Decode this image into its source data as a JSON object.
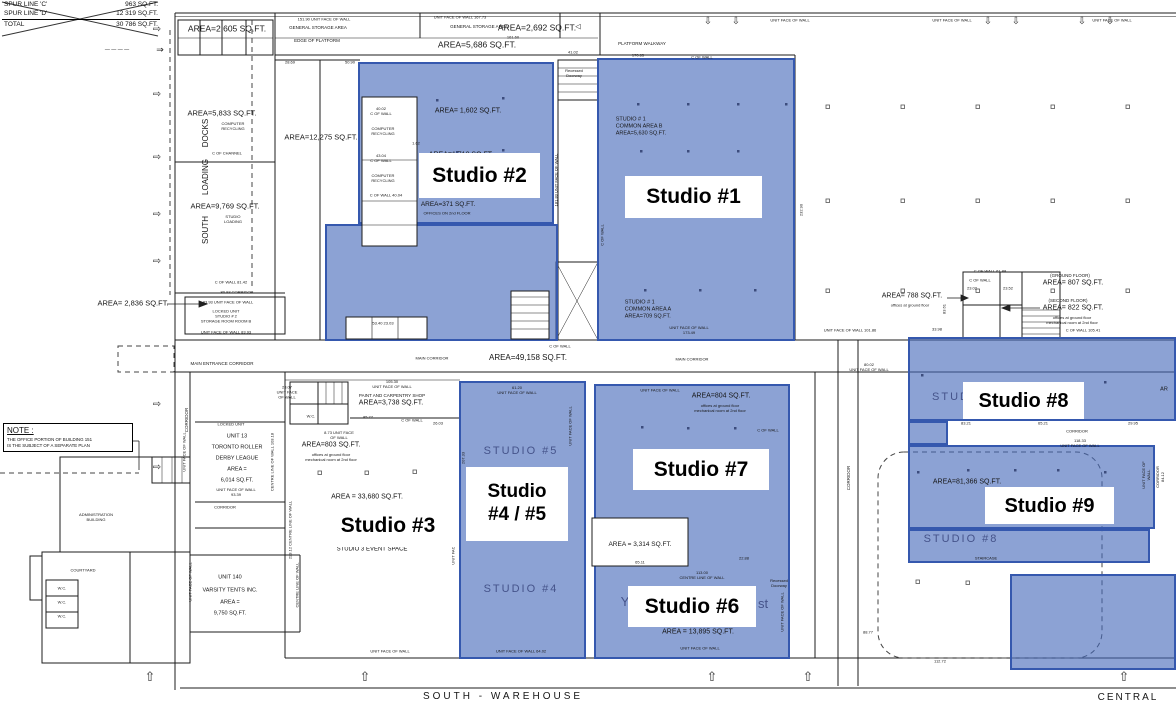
{
  "colors": {
    "highlight_fill": "rgba(70,105,185,0.62)",
    "highlight_border": "#3558ae",
    "wall": "#1c1c1c",
    "ghost_text": "#45538a",
    "plan_text": "#161616"
  },
  "spur_table": {
    "rows": [
      {
        "label": "SPUR LINE 'C'",
        "value": "963 SQ.FT."
      },
      {
        "label": "SPUR LINE 'D'",
        "value": "12 319 SQ.FT."
      },
      {
        "label": "TOTAL",
        "value": "30 786 SQ.FT."
      }
    ]
  },
  "note_box": {
    "title": "NOTE :",
    "body": "THE OFFICE PORTION OF BUILDING 151\nIS THE SUBJECT OF A SEPARATE PLAN"
  },
  "regions": [
    {
      "name": "studio-2-upper",
      "x": 358,
      "y": 62,
      "w": 196,
      "h": 162
    },
    {
      "name": "studio-2-lower",
      "x": 325,
      "y": 224,
      "w": 233,
      "h": 117
    },
    {
      "name": "studio-1",
      "x": 597,
      "y": 58,
      "w": 198,
      "h": 283
    },
    {
      "name": "studio-4-5",
      "x": 459,
      "y": 381,
      "w": 127,
      "h": 278
    },
    {
      "name": "studio-6-7",
      "x": 594,
      "y": 384,
      "w": 196,
      "h": 275
    },
    {
      "name": "studio-8-top",
      "x": 908,
      "y": 337,
      "w": 268,
      "h": 84
    },
    {
      "name": "studio-8-link",
      "x": 908,
      "y": 421,
      "w": 40,
      "h": 24
    },
    {
      "name": "studio-8-9-mid",
      "x": 908,
      "y": 445,
      "w": 247,
      "h": 84
    },
    {
      "name": "studio-8-strip",
      "x": 908,
      "y": 529,
      "w": 242,
      "h": 34
    },
    {
      "name": "studio-9-lower",
      "x": 1010,
      "y": 574,
      "w": 166,
      "h": 96
    }
  ],
  "studio_overlays": [
    {
      "name": "studio-2",
      "text": "Studio #2",
      "x": 419,
      "y": 153,
      "w": 121,
      "h": 45,
      "fs": 21
    },
    {
      "name": "studio-1",
      "text": "Studio #1",
      "x": 625,
      "y": 176,
      "w": 137,
      "h": 42,
      "fs": 21
    },
    {
      "name": "studio-3",
      "text": "Studio #3",
      "x": 318,
      "y": 505,
      "w": 140,
      "h": 42,
      "fs": 21
    },
    {
      "name": "studio-4-5",
      "text": "Studio\n#4 / #5",
      "x": 466,
      "y": 467,
      "w": 102,
      "h": 74,
      "fs": 19
    },
    {
      "name": "studio-7",
      "text": "Studio #7",
      "x": 633,
      "y": 449,
      "w": 136,
      "h": 41,
      "fs": 21
    },
    {
      "name": "studio-6",
      "text": "Studio #6",
      "x": 628,
      "y": 586,
      "w": 128,
      "h": 41,
      "fs": 21
    },
    {
      "name": "studio-8",
      "text": "Studio #8",
      "x": 963,
      "y": 382,
      "w": 121,
      "h": 37,
      "fs": 20
    },
    {
      "name": "studio-9",
      "text": "Studio #9",
      "x": 985,
      "y": 487,
      "w": 129,
      "h": 37,
      "fs": 20
    }
  ],
  "arrows": {
    "left": {
      "glyph": "⇨",
      "x": 157,
      "ys": [
        30,
        95,
        158,
        215,
        262,
        405,
        468
      ]
    },
    "top": {
      "glyph": "⇩",
      "y": 22,
      "xs": [
        708,
        736,
        988,
        1016,
        1082,
        1110
      ]
    },
    "bottom": {
      "glyph": "⇧",
      "y": 677,
      "xs": [
        150,
        365,
        712,
        808,
        1124
      ]
    }
  },
  "plan_texts": [
    {
      "t": "AREA=2,605 SQ.FT.",
      "x": 227,
      "y": 29,
      "s": 8.5
    },
    {
      "t": "151.90   UNIT FACE OF WALL",
      "x": 324,
      "y": 19,
      "s": 4
    },
    {
      "t": "GENERAL STORAGE AREA",
      "x": 318,
      "y": 28,
      "s": 4.5
    },
    {
      "t": "EDGE OF PLATFORM",
      "x": 317,
      "y": 41,
      "s": 4.5
    },
    {
      "t": "28.69",
      "x": 290,
      "y": 62,
      "s": 4
    },
    {
      "t": "50.90",
      "x": 350,
      "y": 62,
      "s": 4
    },
    {
      "t": "UNIT FACE OF WALL  167.73",
      "x": 460,
      "y": 17,
      "s": 4
    },
    {
      "t": "GENERAL STORAGE AREA",
      "x": 479,
      "y": 27,
      "s": 4.5
    },
    {
      "t": "AREA=2,692 SQ.FT.",
      "x": 537,
      "y": 28,
      "s": 8.5
    },
    {
      "t": "161.60",
      "x": 513,
      "y": 37,
      "s": 4
    },
    {
      "t": "AREA=5,686 SQ.FT.",
      "x": 477,
      "y": 45,
      "s": 8.5
    },
    {
      "t": "41.02",
      "x": 573,
      "y": 52,
      "s": 4
    },
    {
      "t": "◁",
      "x": 578,
      "y": 28,
      "s": 7
    },
    {
      "t": "PLATFORM WALKWAY",
      "x": 642,
      "y": 44,
      "s": 4.5
    },
    {
      "t": "170.65",
      "x": 638,
      "y": 55,
      "s": 4
    },
    {
      "t": "C OF WALL",
      "x": 702,
      "y": 57,
      "s": 4
    },
    {
      "t": "UNIT FACE OF WALL",
      "x": 790,
      "y": 20,
      "s": 4
    },
    {
      "t": "UNIT FACE OF WALL",
      "x": 952,
      "y": 20,
      "s": 4
    },
    {
      "t": "UNIT FACE OF WALL",
      "x": 1112,
      "y": 20,
      "s": 4
    },
    {
      "t": "AREA=5,833 SQ.FT.",
      "x": 222,
      "y": 113,
      "s": 7.5
    },
    {
      "t": "COMPUTER\nRECYCLING",
      "x": 233,
      "y": 126,
      "s": 4
    },
    {
      "t": "DOCKS",
      "x": 206,
      "y": 133,
      "s": 8,
      "r": -90
    },
    {
      "t": "C OF CHANNEL",
      "x": 227,
      "y": 153,
      "s": 4
    },
    {
      "t": "LOADING",
      "x": 206,
      "y": 177,
      "s": 8,
      "r": -90
    },
    {
      "t": "AREA=9,769 SQ.FT.",
      "x": 225,
      "y": 206,
      "s": 7.5
    },
    {
      "t": "STUDIO\nLOADING",
      "x": 233,
      "y": 219,
      "s": 4
    },
    {
      "t": "SOUTH",
      "x": 206,
      "y": 230,
      "s": 8,
      "r": -90
    },
    {
      "t": "C OF WALL  81.42",
      "x": 231,
      "y": 282,
      "s": 4
    },
    {
      "t": "80.93   CORRIDOR",
      "x": 237,
      "y": 292,
      "s": 4
    },
    {
      "t": "AREA= 2,836 SQ.FT.",
      "x": 133,
      "y": 303,
      "s": 7.5
    },
    {
      "t": "83.93   UNIT FACE OF WALL",
      "x": 228,
      "y": 302,
      "s": 4
    },
    {
      "t": "LOCKED UNIT\nSTUDIO # 2\nSTORAGE ROOM ROOM B",
      "x": 226,
      "y": 316,
      "s": 4
    },
    {
      "t": "UNIT FACE OF WALL  83.93",
      "x": 226,
      "y": 332,
      "s": 4
    },
    {
      "t": "MAIN ENTRANCE CORRIDOR",
      "x": 222,
      "y": 364,
      "s": 4.5
    },
    {
      "t": "AREA=12,275 SQ.FT.",
      "x": 321,
      "y": 137,
      "s": 7.5
    },
    {
      "t": "40.02\nC OF WALL",
      "x": 381,
      "y": 111,
      "s": 4
    },
    {
      "t": "COMPUTER\nRECYCLING",
      "x": 383,
      "y": 131,
      "s": 4
    },
    {
      "t": "43.04\nC OF WALL",
      "x": 381,
      "y": 158,
      "s": 4
    },
    {
      "t": "COMPUTER\nRECYCLING",
      "x": 383,
      "y": 178,
      "s": 4
    },
    {
      "t": "C OF WALL  40.04",
      "x": 386,
      "y": 195,
      "s": 4
    },
    {
      "t": "AREA= 1,602 SQ.FT.",
      "x": 468,
      "y": 112,
      "s": 7
    },
    {
      "t": "1.62",
      "x": 416,
      "y": 143,
      "s": 4
    },
    {
      "t": "AREA=1,718 SQ.FT.",
      "x": 461,
      "y": 156,
      "s": 7
    },
    {
      "t": "AREA=371 SQ.FT.",
      "x": 448,
      "y": 205,
      "s": 6.5
    },
    {
      "t": "OFFICES ON 2nd FLOOR",
      "x": 447,
      "y": 213,
      "s": 4
    },
    {
      "t": "53.40   23.03",
      "x": 383,
      "y": 323,
      "s": 4
    },
    {
      "t": "Recessed\nDoorway",
      "x": 574,
      "y": 73,
      "s": 4
    },
    {
      "t": "181.83  UNIT FACE OF WALL",
      "x": 556,
      "y": 180,
      "s": 4,
      "r": -90
    },
    {
      "t": "STUDIO # 1\nCOMMON AREA B\nAREA=5,630 SQ.FT.",
      "x": 641,
      "y": 127,
      "s": 5.5,
      "a": "left"
    },
    {
      "t": "STUDIO # 1\nCOMMON AREA A\nAREA=709 SQ.FT.",
      "x": 648,
      "y": 310,
      "s": 5.5,
      "a": "left"
    },
    {
      "t": "UNIT FACE OF WALL\n173.49",
      "x": 689,
      "y": 330,
      "s": 4
    },
    {
      "t": "C OF WALL",
      "x": 602,
      "y": 235,
      "s": 4,
      "r": -90
    },
    {
      "t": "232.90",
      "x": 801,
      "y": 210,
      "s": 4,
      "r": -90
    },
    {
      "t": "MAIN CORRIDOR",
      "x": 432,
      "y": 358,
      "s": 4
    },
    {
      "t": "AREA=49,158 SQ.FT.",
      "x": 528,
      "y": 358,
      "s": 8
    },
    {
      "t": "MAIN CORRIDOR",
      "x": 692,
      "y": 359,
      "s": 4
    },
    {
      "t": "C OF WALL",
      "x": 560,
      "y": 346,
      "s": 4
    },
    {
      "t": "C OF WALL    61.88",
      "x": 990,
      "y": 271,
      "s": 4
    },
    {
      "t": "C OF WALL",
      "x": 980,
      "y": 280,
      "s": 4
    },
    {
      "t": "23.02",
      "x": 972,
      "y": 288,
      "s": 4
    },
    {
      "t": "23.52",
      "x": 1008,
      "y": 288,
      "s": 4
    },
    {
      "t": "AREA= 788 SQ.FT.",
      "x": 912,
      "y": 297,
      "s": 7
    },
    {
      "t": "offices at ground floor",
      "x": 910,
      "y": 305,
      "s": 4
    },
    {
      "t": "(GROUND FLOOR)",
      "x": 1070,
      "y": 276,
      "s": 4.5
    },
    {
      "t": "AREA= 807 SQ.FT.",
      "x": 1073,
      "y": 284,
      "s": 7
    },
    {
      "t": "(SECOND FLOOR)",
      "x": 1068,
      "y": 301,
      "s": 4.5
    },
    {
      "t": "AREA= 822 SQ.FT.",
      "x": 1073,
      "y": 309,
      "s": 7
    },
    {
      "t": "offices at ground floor\nmechanical room at 2nd floor",
      "x": 1072,
      "y": 320,
      "s": 4
    },
    {
      "t": "UNIT FACE OF WALL  101.86",
      "x": 850,
      "y": 330,
      "s": 4
    },
    {
      "t": "33.98",
      "x": 937,
      "y": 329,
      "s": 4
    },
    {
      "t": "C OF WALL  105.41",
      "x": 1083,
      "y": 330,
      "s": 4
    },
    {
      "t": "83.61",
      "x": 944,
      "y": 309,
      "s": 4,
      "r": -90
    },
    {
      "t": "80.02\nUNIT FACE OF WALL",
      "x": 869,
      "y": 367,
      "s": 4
    },
    {
      "t": "CORRIDOR",
      "x": 849,
      "y": 478,
      "s": 4.5,
      "r": -90
    },
    {
      "t": "88.77",
      "x": 868,
      "y": 632,
      "s": 4
    },
    {
      "t": "112.72",
      "x": 940,
      "y": 661,
      "s": 4
    },
    {
      "t": "61.20\nUNIT FACE OF WALL",
      "x": 517,
      "y": 390,
      "s": 4
    },
    {
      "t": "STUDIO #5",
      "x": 521,
      "y": 452,
      "s": 11,
      "c": "ghost",
      "ls": 2
    },
    {
      "t": "STUDIO #4",
      "x": 521,
      "y": 590,
      "s": 11,
      "c": "ghost",
      "ls": 2
    },
    {
      "t": "207.33",
      "x": 463,
      "y": 458,
      "s": 4,
      "r": -90
    },
    {
      "t": "UNIT FACE OF WALL",
      "x": 570,
      "y": 426,
      "s": 4,
      "r": -90
    },
    {
      "t": "UNIT FACE OF WALL  64.02",
      "x": 521,
      "y": 651,
      "s": 4
    },
    {
      "t": "UNIT FACE OF WALL",
      "x": 660,
      "y": 390,
      "s": 4
    },
    {
      "t": "AREA=804 SQ.FT.",
      "x": 721,
      "y": 397,
      "s": 7
    },
    {
      "t": "offices at ground floor\nmechanical room at 2nd floor",
      "x": 720,
      "y": 408,
      "s": 4
    },
    {
      "t": "C OF WALL",
      "x": 768,
      "y": 430,
      "s": 4
    },
    {
      "t": "AREA = 3,314 SQ.FT.",
      "x": 640,
      "y": 545,
      "s": 6.5
    },
    {
      "t": "65.11",
      "x": 640,
      "y": 562,
      "s": 4
    },
    {
      "t": "22.88",
      "x": 744,
      "y": 558,
      "s": 4
    },
    {
      "t": "113.00\nCENTRE LINE OF WALL",
      "x": 702,
      "y": 575,
      "s": 4
    },
    {
      "t": "Y",
      "x": 625,
      "y": 602,
      "s": 13,
      "c": "ghost"
    },
    {
      "t": "st",
      "x": 763,
      "y": 604,
      "s": 13,
      "c": "ghost"
    },
    {
      "t": "AREA = 13,895 SQ.FT.",
      "x": 698,
      "y": 633,
      "s": 7
    },
    {
      "t": "UNIT FACE OF WALL",
      "x": 700,
      "y": 648,
      "s": 4
    },
    {
      "t": "Recessed\nDoorway",
      "x": 779,
      "y": 583,
      "s": 4
    },
    {
      "t": "UNIT FACE OF WALL",
      "x": 782,
      "y": 612,
      "s": 4,
      "r": -90
    },
    {
      "t": "83.21",
      "x": 966,
      "y": 423,
      "s": 4
    },
    {
      "t": "65.21",
      "x": 1043,
      "y": 423,
      "s": 4
    },
    {
      "t": "29.95",
      "x": 1133,
      "y": 423,
      "s": 4
    },
    {
      "t": "CORRIDOR",
      "x": 1077,
      "y": 431,
      "s": 4
    },
    {
      "t": "118.33\nUNIT FACE OF WALL",
      "x": 1080,
      "y": 443,
      "s": 4
    },
    {
      "t": "STUD",
      "x": 951,
      "y": 398,
      "s": 11,
      "c": "ghost",
      "ls": 2
    },
    {
      "t": "AREA=81,366 SQ.FT.",
      "x": 967,
      "y": 483,
      "s": 7
    },
    {
      "t": "STUDIO #8",
      "x": 961,
      "y": 540,
      "s": 11,
      "c": "ghost",
      "ls": 2
    },
    {
      "t": "STAIRCASE",
      "x": 986,
      "y": 558,
      "s": 4
    },
    {
      "t": "UNIT FACE OF WALL",
      "x": 1146,
      "y": 475,
      "s": 4,
      "r": -90
    },
    {
      "t": "CORRIDOR   84.12",
      "x": 1160,
      "y": 477,
      "s": 4,
      "r": -90
    },
    {
      "t": "AR",
      "x": 1164,
      "y": 390,
      "s": 5.5
    },
    {
      "t": "CORRIDOR",
      "x": 187,
      "y": 420,
      "s": 4.5,
      "r": -90
    },
    {
      "t": "23.07\nUNIT FACE\nOF WALL",
      "x": 287,
      "y": 392,
      "s": 4
    },
    {
      "t": "LOCKED UNIT",
      "x": 231,
      "y": 424,
      "s": 4
    },
    {
      "t": "UNIT  13",
      "x": 237,
      "y": 437,
      "s": 5.5
    },
    {
      "t": "TORONTO ROLLER",
      "x": 237,
      "y": 448,
      "s": 5.5
    },
    {
      "t": "DERBY LEAGUE",
      "x": 237,
      "y": 459,
      "s": 5.5
    },
    {
      "t": "AREA  =",
      "x": 237,
      "y": 470,
      "s": 5.5
    },
    {
      "t": "6,014 SQ.FT.",
      "x": 237,
      "y": 481,
      "s": 5.5
    },
    {
      "t": "UNIT FACE OF WALL\n93.39",
      "x": 236,
      "y": 492,
      "s": 4
    },
    {
      "t": "CORRIDOR",
      "x": 225,
      "y": 507,
      "s": 4
    },
    {
      "t": "UNIT FACE OF WALL",
      "x": 184,
      "y": 452,
      "s": 4,
      "r": -90
    },
    {
      "t": "CENTRE LINE OF WALL  103.18",
      "x": 272,
      "y": 462,
      "s": 4,
      "r": -90
    },
    {
      "t": "UNIT 140",
      "x": 230,
      "y": 578,
      "s": 5.5
    },
    {
      "t": "VARSITY TENTS INC.",
      "x": 230,
      "y": 591,
      "s": 5.5
    },
    {
      "t": "AREA  =",
      "x": 230,
      "y": 603,
      "s": 5.5
    },
    {
      "t": "9,750 SQ.FT.",
      "x": 230,
      "y": 614,
      "s": 5.5
    },
    {
      "t": "UNIT FACE OF WALL",
      "x": 190,
      "y": 582,
      "s": 4,
      "r": -90
    },
    {
      "t": "CENTRE LINE OF WALL",
      "x": 297,
      "y": 585,
      "s": 4,
      "r": -90
    },
    {
      "t": "105.30\nUNIT FACE OF WALL",
      "x": 392,
      "y": 384,
      "s": 4
    },
    {
      "t": "PAINT AND CARPENTRY SHOP",
      "x": 392,
      "y": 396,
      "s": 4.5
    },
    {
      "t": "AREA=3,738 SQ.FT.",
      "x": 391,
      "y": 404,
      "s": 7
    },
    {
      "t": "85.77",
      "x": 368,
      "y": 417,
      "s": 4
    },
    {
      "t": "C OF WALL",
      "x": 412,
      "y": 420,
      "s": 4
    },
    {
      "t": "26.03",
      "x": 438,
      "y": 423,
      "s": 4
    },
    {
      "t": "W.C.",
      "x": 311,
      "y": 416,
      "s": 4
    },
    {
      "t": "8.73  UNIT FACE\nOF WALL",
      "x": 339,
      "y": 435,
      "s": 4
    },
    {
      "t": "AREA=803 SQ.FT.",
      "x": 331,
      "y": 446,
      "s": 7
    },
    {
      "t": "offices at ground floor\nmechanical room at 2nd floor",
      "x": 331,
      "y": 457,
      "s": 4
    },
    {
      "t": "AREA = 33,680 SQ.FT.",
      "x": 367,
      "y": 498,
      "s": 7
    },
    {
      "t": "STUDIO 3 EVENT SPACE",
      "x": 372,
      "y": 550,
      "s": 6
    },
    {
      "t": "UNIT FACE OF WALL",
      "x": 390,
      "y": 651,
      "s": 4
    },
    {
      "t": "223.12  CENTRE LINE OF WALL",
      "x": 290,
      "y": 530,
      "s": 4,
      "r": -90
    },
    {
      "t": "UNIT FACE OF WALL",
      "x": 453,
      "y": 545,
      "s": 4,
      "r": -90
    },
    {
      "t": "ADMINISTRATION\nBUILDING",
      "x": 96,
      "y": 517,
      "s": 4
    },
    {
      "t": "COURTYARD",
      "x": 83,
      "y": 570,
      "s": 4
    },
    {
      "t": "W.C.",
      "x": 62,
      "y": 588,
      "s": 4
    },
    {
      "t": "W.C.",
      "x": 62,
      "y": 602,
      "s": 4
    },
    {
      "t": "W.C.",
      "x": 62,
      "y": 616,
      "s": 4
    },
    {
      "t": "SOUTH  -  WAREHOUSE",
      "x": 503,
      "y": 697,
      "s": 10,
      "ls": 3
    },
    {
      "t": "CENTRAL",
      "x": 1128,
      "y": 698,
      "s": 10,
      "ls": 2
    },
    {
      "t": "— — — —",
      "x": 117,
      "y": 50,
      "s": 5
    },
    {
      "t": "⇒",
      "x": 160,
      "y": 50,
      "s": 9
    }
  ]
}
